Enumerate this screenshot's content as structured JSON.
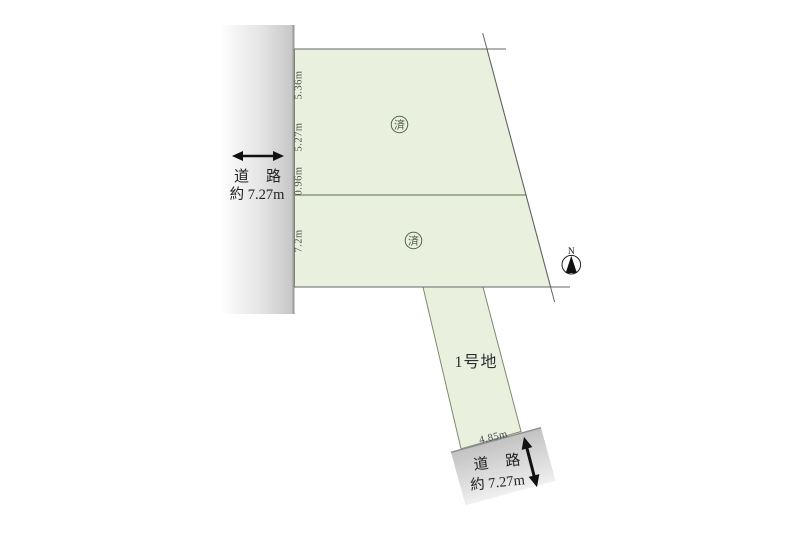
{
  "map": {
    "left_road": {
      "name": "道　路",
      "width": "約 7.27m"
    },
    "bottom_road": {
      "name": "道　路",
      "width": "約 7.27m",
      "frontage": "4.85m"
    },
    "plots": {
      "upper": {
        "stamp": "済"
      },
      "lower": {
        "stamp": "済"
      },
      "flag": {
        "label": "1号地"
      }
    },
    "measurements": {
      "seg1": "5.36m",
      "seg2": "5.27m",
      "seg3": "0.96m",
      "seg4": "7.2m"
    },
    "compass": {
      "north": "N"
    },
    "colors": {
      "plot_fill": "#e9f1de",
      "plot_stroke": "#7b8a6d",
      "divider_line": "#8c9a80",
      "boundary_line": "#666666",
      "road_gray": "#c6c6c6",
      "road_edge": "#9b9b9b",
      "arrow_black": "#111111",
      "text": "#333333"
    }
  }
}
